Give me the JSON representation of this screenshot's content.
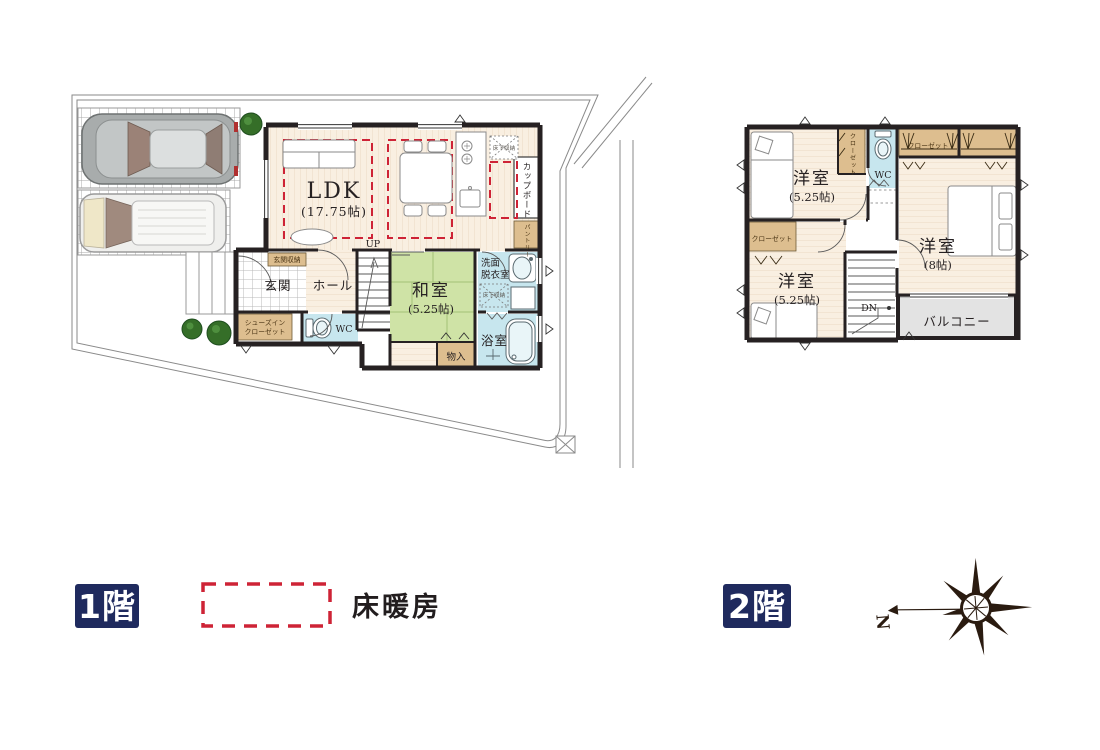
{
  "legend": {
    "floor1_label": "1階",
    "floor2_label": "2階",
    "floor_heating": "床暖房",
    "north": "N"
  },
  "floor1": {
    "ldk_name": "LDK",
    "ldk_size": "(17.75帖)",
    "washitsu_name": "和室",
    "washitsu_size": "(5.25帖)",
    "genkan": "玄関",
    "hall": "ホール",
    "genkan_storage": "玄関収納",
    "shoes_closet_line1": "シューズイン",
    "shoes_closet_line2": "クローゼット",
    "wc": "WC",
    "washroom_line1": "洗面",
    "washroom_line2": "脱衣室",
    "bathroom": "浴室",
    "pantry": "パントリー",
    "cupboard": "カップボード",
    "underfloor_kitchen": "床下収納",
    "underfloor_wash": "床下収納",
    "storage": "物入",
    "up": "UP"
  },
  "floor2": {
    "bedroom1_name": "洋室",
    "bedroom1_size": "(5.25帖)",
    "bedroom2_name": "洋室",
    "bedroom2_size": "(8帖)",
    "bedroom3_name": "洋室",
    "bedroom3_size": "(5.25帖)",
    "closet_top_left": "クローゼット",
    "closet_top": "クローゼット",
    "closet_bottom": "クローゼット",
    "wc": "WC",
    "balcony": "バルコニー",
    "dn": "DN"
  },
  "colors": {
    "wall": "#262122",
    "wood_floor": "#f9efe1",
    "wood_stripe": "#ecd9c4",
    "tatami": "#cfe3a6",
    "water_blue": "#c7e6ee",
    "closet_tan": "#ddbe8f",
    "balcony_gray": "#e3e3e3",
    "heating_red": "#ce2336",
    "badge_navy": "#1f2a5e",
    "tree_green": "#356e28",
    "site_line": "#8a8a8a"
  }
}
